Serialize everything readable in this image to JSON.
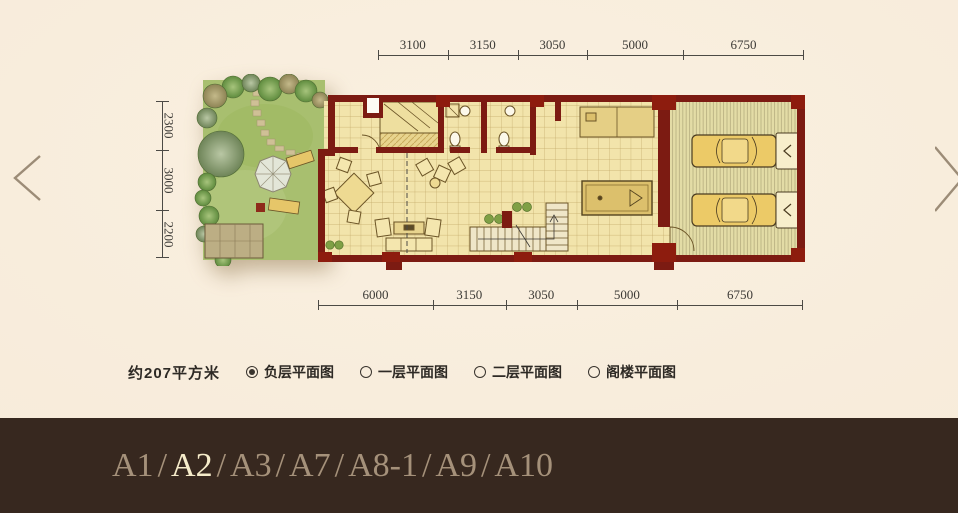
{
  "plan": {
    "area_label": "约207平方米",
    "dimensions": {
      "top": [
        "3100",
        "3150",
        "3050",
        "5000",
        "6750"
      ],
      "bottom": [
        "6000",
        "3150",
        "3050",
        "5000",
        "6750"
      ],
      "left": [
        "2300",
        "3000",
        "2200"
      ]
    }
  },
  "floor_options": [
    {
      "label": "负层平面图",
      "selected": true
    },
    {
      "label": "一层平面图",
      "selected": false
    },
    {
      "label": "二层平面图",
      "selected": false
    },
    {
      "label": "阁楼平面图",
      "selected": false
    }
  ],
  "footer": {
    "items": [
      "A1",
      "A2",
      "A3",
      "A7",
      "A8-1",
      "A9",
      "A10"
    ],
    "active": "A2",
    "separator": "/"
  },
  "colors": {
    "background": "#f7ebda",
    "wall": "#7c1b12",
    "floor": "#f2e4ab",
    "garage_floor": "#e3dca6",
    "garden_green": "#a8bf6f",
    "footer_bg": "#37281f",
    "footer_text": "#a5917a",
    "footer_active": "#f6ecca",
    "dimension_text": "#3c3a36"
  }
}
